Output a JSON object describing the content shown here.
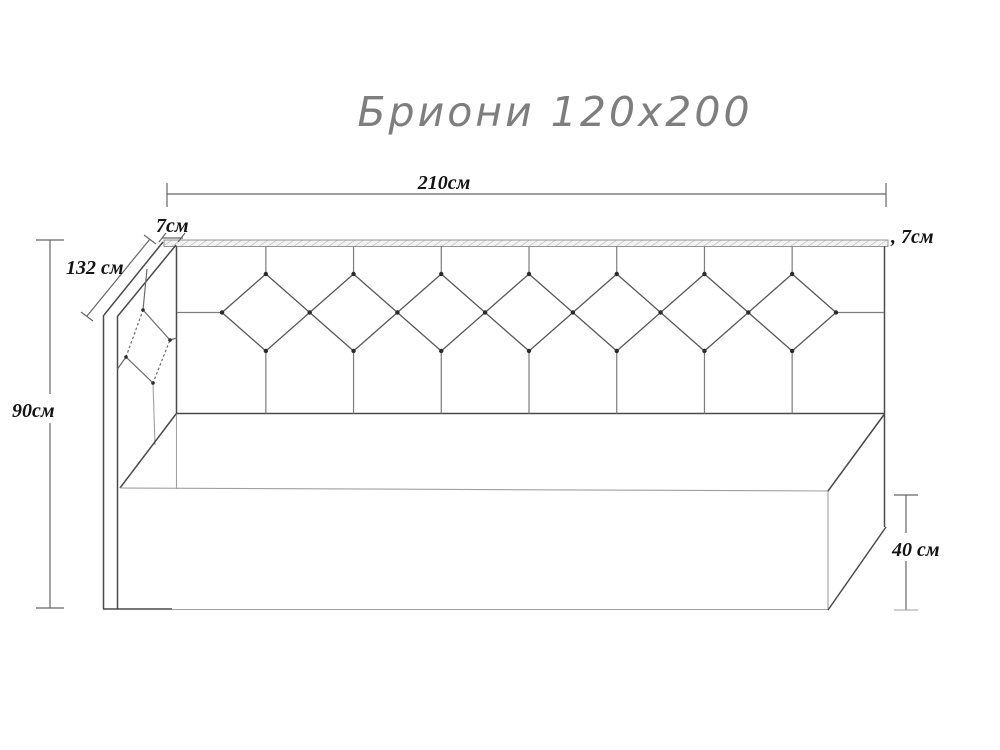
{
  "title": "Бриони 120х200",
  "product": {
    "name": "Бриони",
    "size": "120х200"
  },
  "dimension_labels": {
    "total_width": "210см",
    "top_board_thickness_left": "7см",
    "top_board_thickness_right": ", 7см",
    "side_backrest_depth": "132 см",
    "total_height": "90см",
    "base_height": "40 см"
  },
  "drawing": {
    "kind": "furniture dimensional line drawing",
    "subject": "corner bed / sofa with tufted diamond headboard",
    "headboard_diamond_count": 7,
    "side_panel_diamond_count": 1
  },
  "colors": {
    "background": "#ffffff",
    "line_dark": "#4a4a4a",
    "line_light": "#a0a0a0",
    "title_gray": "#7e7e7e",
    "label_text": "#141414"
  }
}
